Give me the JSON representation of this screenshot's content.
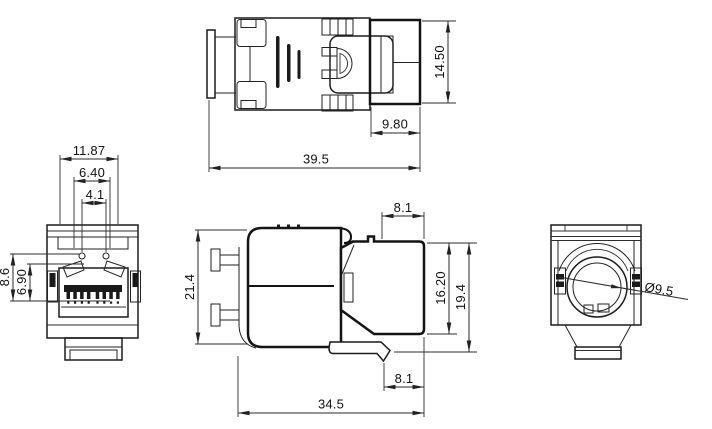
{
  "drawing": {
    "background": "#ffffff",
    "line_color": "#1a1a1a",
    "views": {
      "top": {
        "dims": {
          "height": "14.50",
          "rear_depth": "9.80",
          "overall_length": "39.5"
        }
      },
      "front": {
        "dims": {
          "width": "11.87",
          "opening_width": "6.40",
          "pin_pitch": "4.1",
          "opening_height": "8.6",
          "inner_height": "6.90"
        }
      },
      "side": {
        "dims": {
          "nose_depth_top": "8.1",
          "body_height": "21.4",
          "face_height": "16.20",
          "overall_height": "19.4",
          "nose_depth_bottom": "8.1",
          "overall_length": "34.5"
        }
      },
      "rear": {
        "dims": {
          "cable_hole_diameter": "Ø9.5"
        }
      }
    }
  }
}
